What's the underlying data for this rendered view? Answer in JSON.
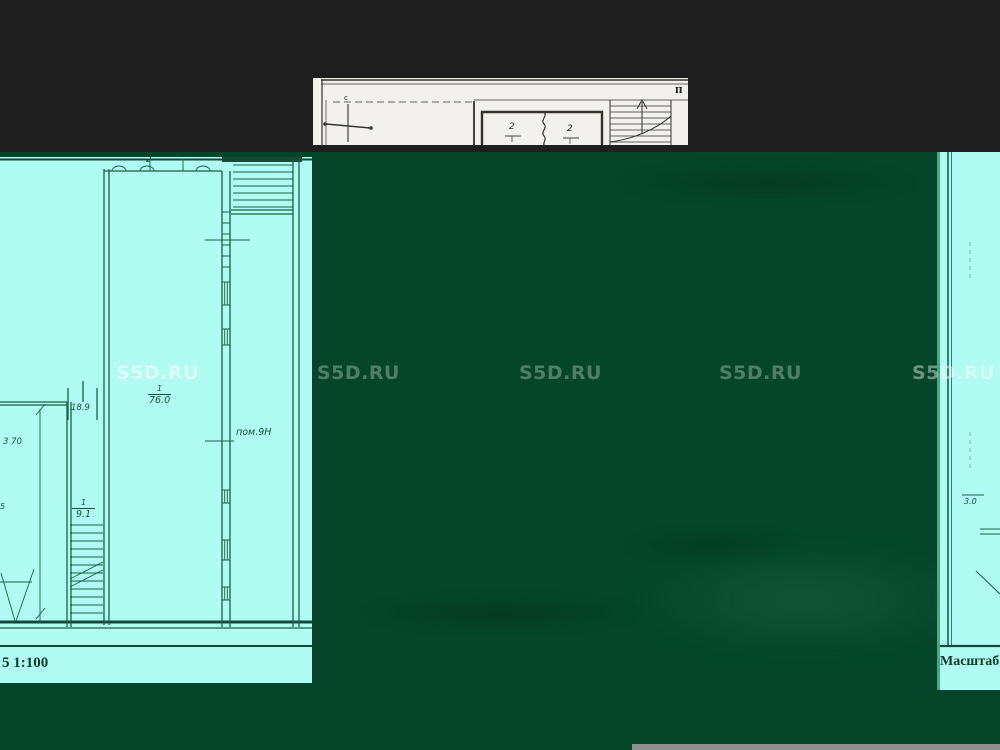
{
  "watermark": {
    "text": "S5D.RU"
  },
  "colors": {
    "background": "#1e1e1e",
    "overlay_green": "#05462a",
    "plan_paper_cyan": "#b0fcf2",
    "plan_line_teal": "#1a5e45",
    "paper_white": "#f2f1ed",
    "paper_line": "#35322e",
    "divider_green": "#3fae7e",
    "scrollbar_gray": "#8f8f8f"
  },
  "top_fragment": {
    "corner_letter": "п",
    "compass_north_label": "с",
    "room_left_number": "2",
    "room_right_number": "2"
  },
  "left_fragment": {
    "top_room_number": "2",
    "main_room_number": "1",
    "main_room_area": "76.0",
    "room_name": "пом.9Н",
    "dim_horizontal": "18.9",
    "dim_vertical": "3 70",
    "stair_room_number": "1",
    "stair_room_area": "9.1",
    "edge_dim": "5",
    "scale_label": "5 1:100"
  },
  "right_fragment": {
    "dim": "3.0",
    "scale_label": "Масштаб"
  }
}
